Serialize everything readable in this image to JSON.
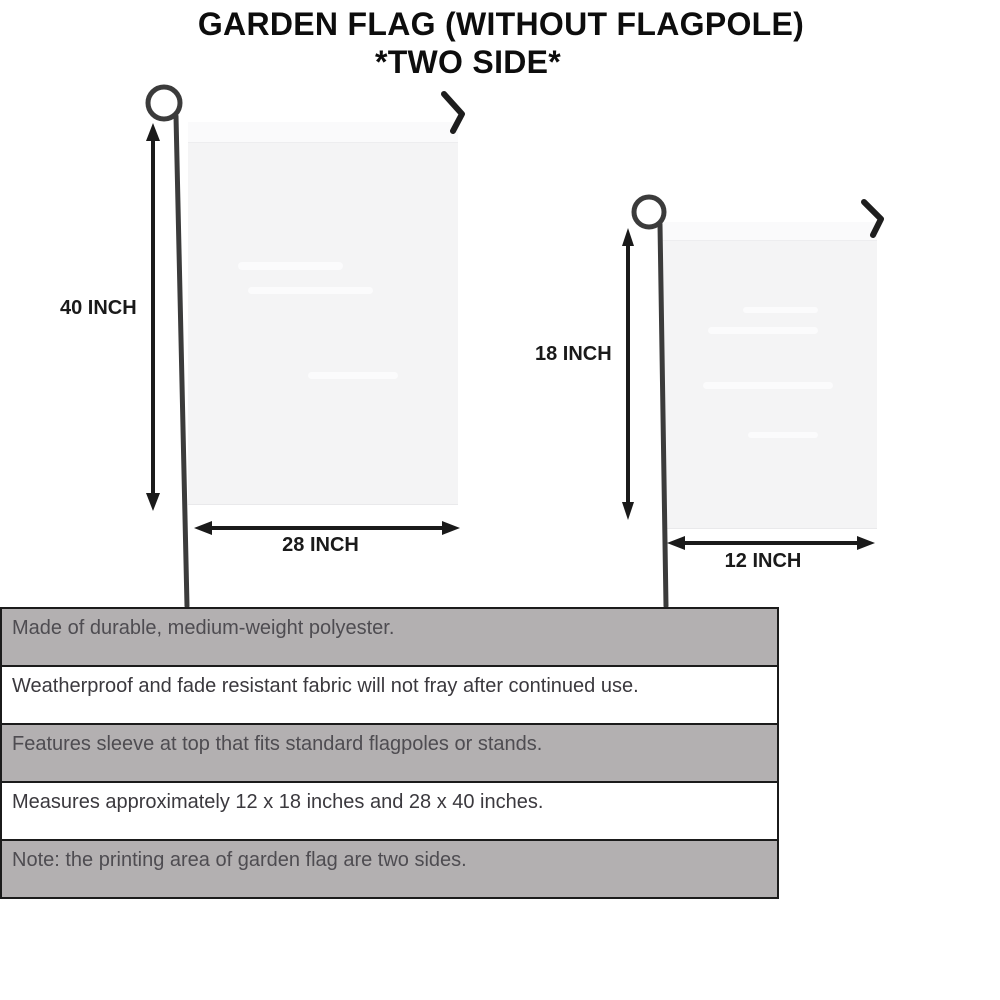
{
  "title": {
    "line1": "GARDEN FLAG (WITHOUT FLAGPOLE)",
    "line2": "*TWO SIDE*"
  },
  "flags": {
    "large": {
      "height_label": "40 INCH",
      "width_label": "28 INCH"
    },
    "small": {
      "height_label": "18 INCH",
      "width_label": "12 INCH"
    }
  },
  "features": [
    {
      "text": "Made of durable, medium-weight polyester.",
      "shaded": true
    },
    {
      "text": "Weatherproof and fade resistant fabric will not fray after continued use.",
      "shaded": false
    },
    {
      "text": "Features sleeve at top that fits standard flagpoles or stands.",
      "shaded": true
    },
    {
      "text": "Measures approximately 12 x 18 inches and 28 x 40 inches.",
      "shaded": false
    },
    {
      "text": "Note: the printing area of garden flag are two sides.",
      "shaded": true
    }
  ],
  "colors": {
    "background": "#ffffff",
    "title_text": "#0d0d0d",
    "dimension_text": "#1a1a1a",
    "pole": "#3b3b3b",
    "hook": "#1e1e1e",
    "flag_fill": "#f4f4f5",
    "flag_sleeve": "#fafafb",
    "table_row_gray": "#b3b0b1",
    "table_row_white": "#ffffff",
    "table_border": "#1b1b1b"
  }
}
